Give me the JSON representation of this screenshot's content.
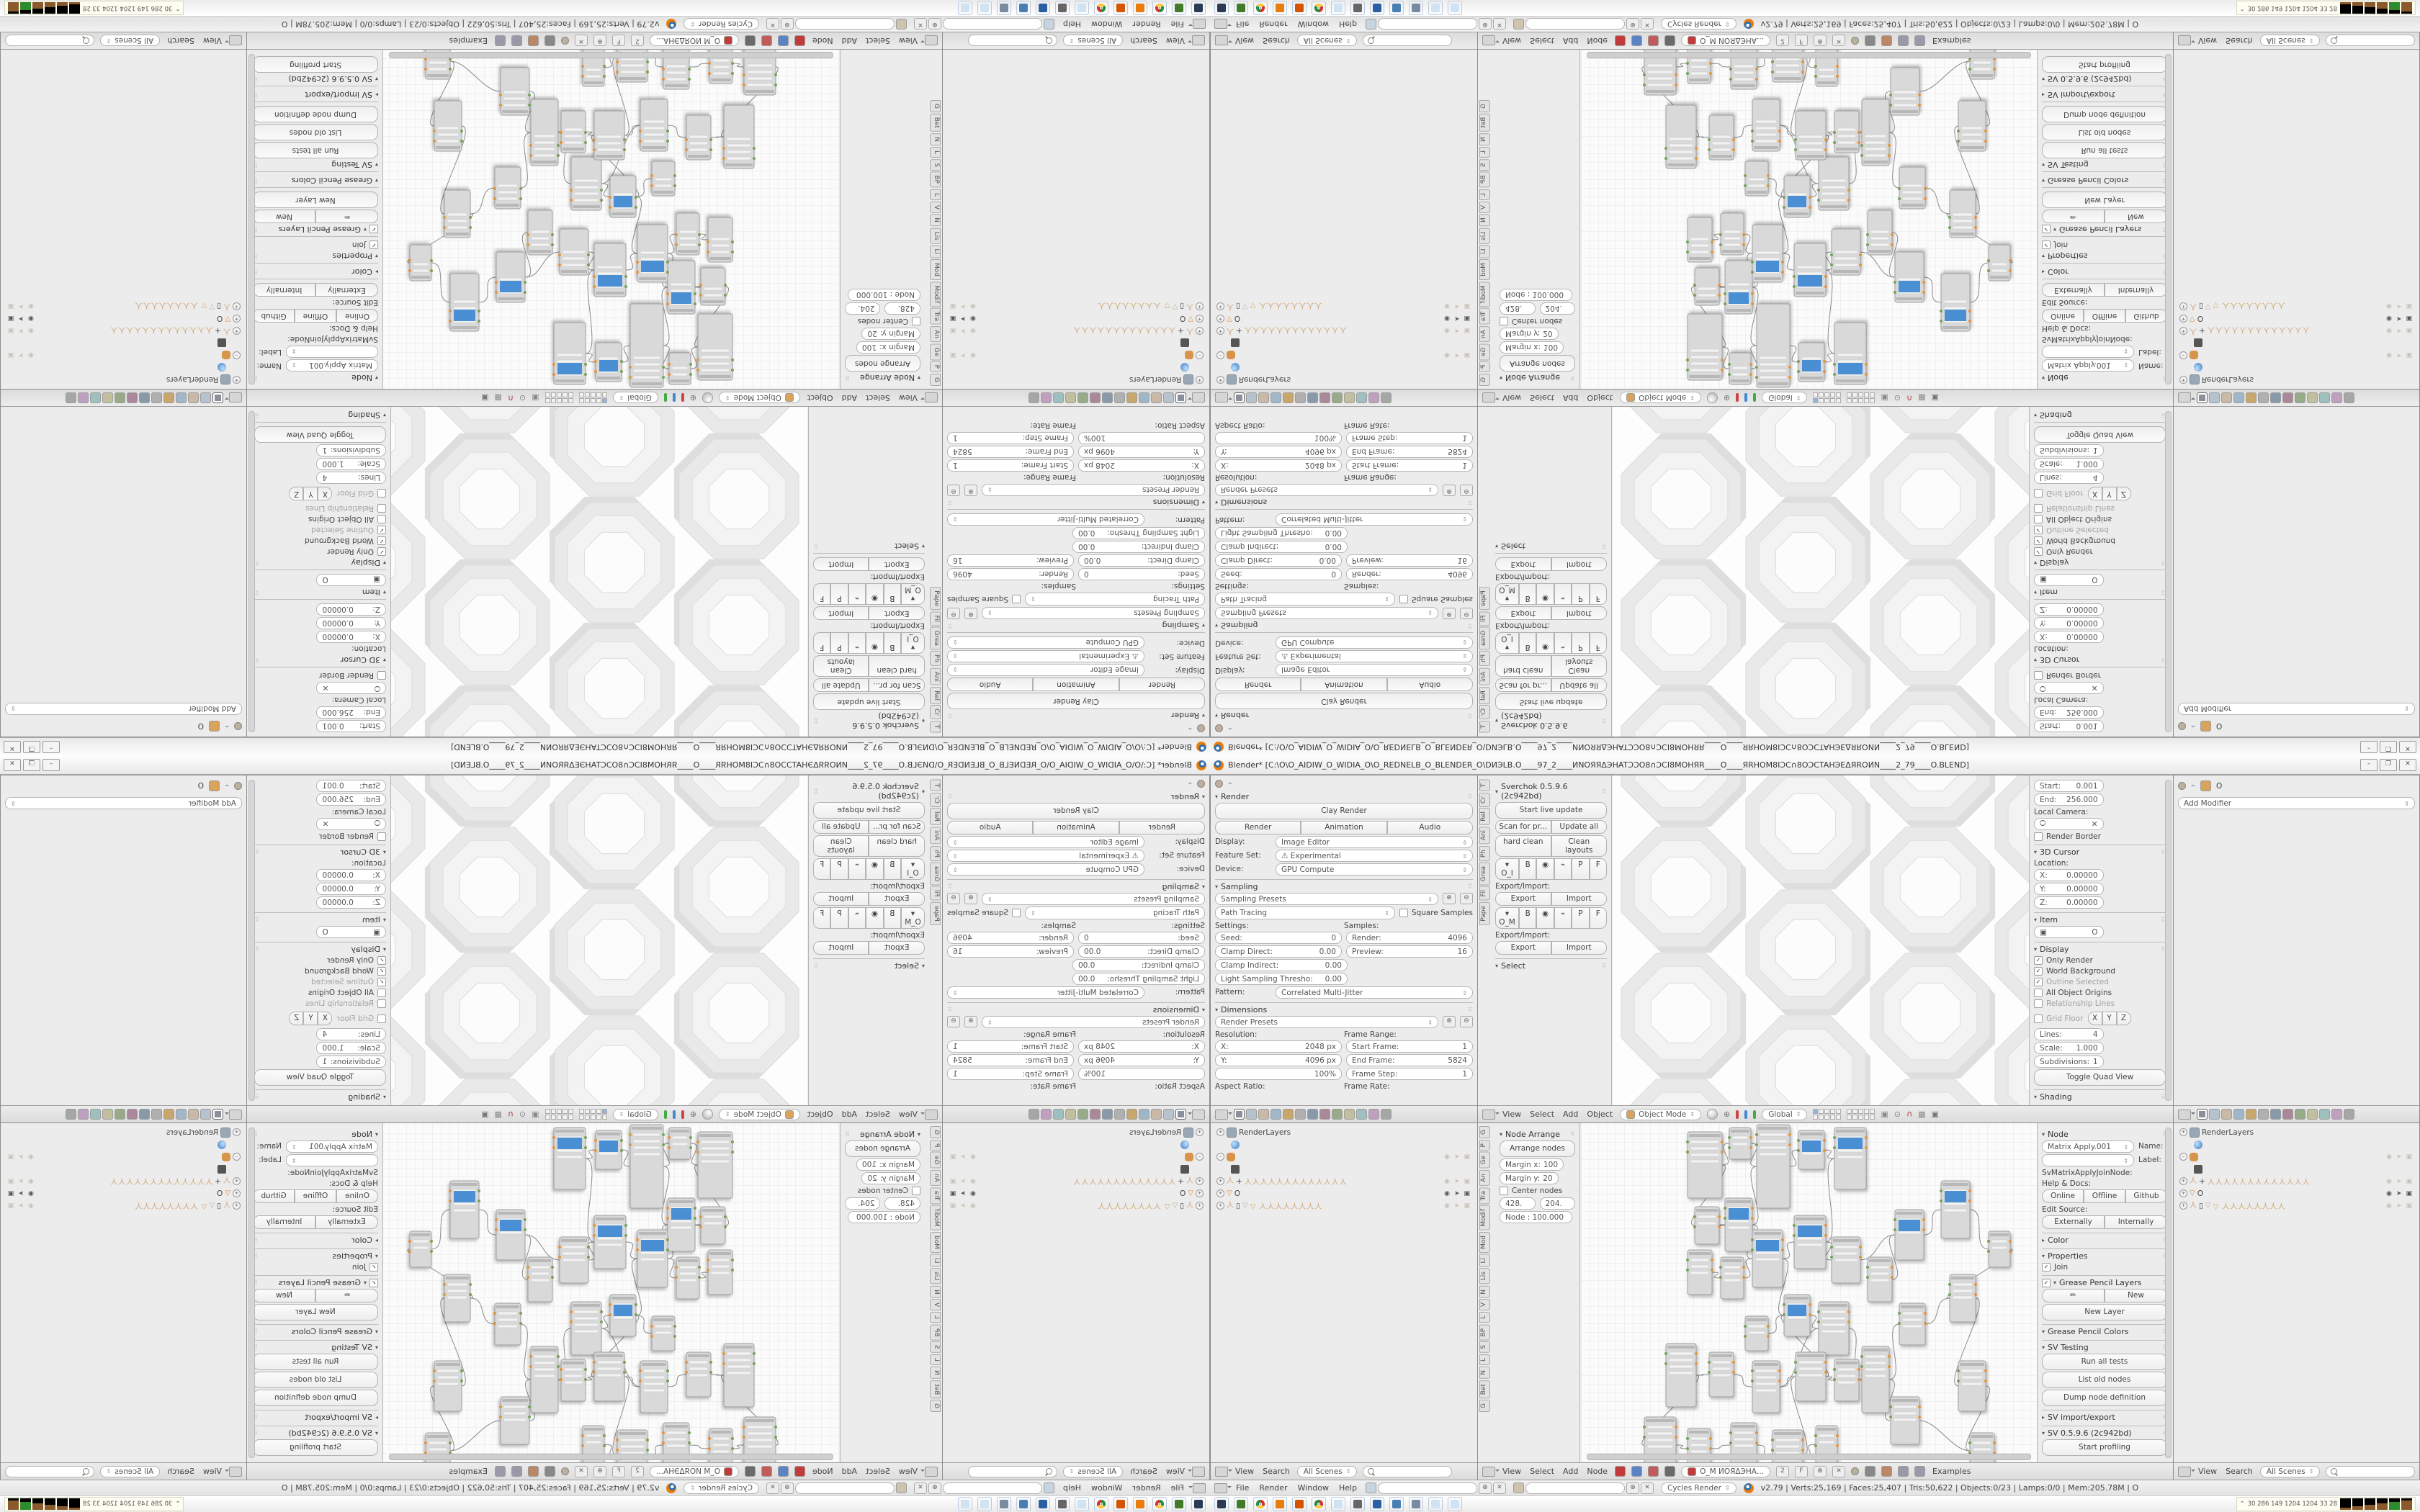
{
  "window": {
    "title": "Blender* [C:\\O\\O_AIDIW_O_WIDIA_O\\O_REDNELB_O_BLENDER_O\\DИЭLB.O____97_2____ИNOЯЯΔЭHATƆƆO8∩ƆCI8MOHЯR____O____ЯRHOM8IƆC∩8OƆCTAHЭEΔЯROИN____2_79____O.BLEND]",
    "controls": {
      "minimize": "–",
      "maximize": "❐",
      "close": "✕"
    }
  },
  "colors": {
    "accent_blue": "#4a8fd3",
    "blender_orange": "#e87d0d",
    "node_fill": "#d9d9d9",
    "wire": "#8a8a8a",
    "socket_green": "#7aa05a",
    "socket_orange": "#e0953f",
    "prop_tabs": [
      "#8a8f99",
      "#b7c3cc",
      "#c9b9a6",
      "#9fb7c9",
      "#c9a66b",
      "#b0b0b0",
      "#8899aa",
      "#aa8899",
      "#99aa88",
      "#c0c0a0",
      "#a0c0c0",
      "#c0a0c0",
      "#a6a6a6"
    ],
    "node_header_chips": [
      "#c23b3b",
      "#5a84c4",
      "#c25b5b",
      "#6a6a6a"
    ],
    "taskbar_icons": [
      {
        "name": "system-monitor-icon",
        "c": "#2b3a55"
      },
      {
        "name": "package-manager-icon",
        "c": "#3f7d2c"
      },
      {
        "name": "chrome-icon",
        "c": "#d93025"
      },
      {
        "name": "blender-app-icon",
        "c": "#e87d0d"
      },
      {
        "name": "spiral-app-icon",
        "c": "#d45500"
      },
      {
        "name": "browser-icon",
        "c": "#1a73e8"
      },
      {
        "name": "notepad-icon",
        "c": "#cfe3f5"
      },
      {
        "name": "speaker-icon",
        "c": "#666666"
      },
      {
        "name": "fl64-icon",
        "c": "#2b5fa3"
      },
      {
        "name": "image-viewer-icon",
        "c": "#4a7fb5"
      },
      {
        "name": "calculator-icon",
        "c": "#7a8aa0"
      },
      {
        "name": "notepad2-icon",
        "c": "#cfe3f5"
      },
      {
        "name": "notepad3-icon",
        "c": "#cfe3f5"
      }
    ]
  },
  "props_render": {
    "panels": [
      {
        "t": "pins"
      },
      {
        "t": "ph",
        "l": "Render"
      },
      {
        "t": "btnbig",
        "l": "Clay Render"
      },
      {
        "t": "btnrow",
        "b": [
          "Render",
          "Animation",
          "Audio"
        ]
      },
      {
        "t": "selrow",
        "l": "Display:",
        "v": "Image Editor"
      },
      {
        "t": "selrow",
        "l": "Feature Set:",
        "v": "⚠ Experimental"
      },
      {
        "t": "selrow",
        "l": "Device:",
        "v": "GPU Compute"
      },
      {
        "t": "ph",
        "l": "Sampling",
        "rule": 1
      },
      {
        "t": "preset",
        "l": "Sampling Presets"
      },
      {
        "t": "pathrow",
        "l": "Path Tracing",
        "c": "Square Samples"
      },
      {
        "t": "lblrow",
        "a": "Settings:",
        "b": "Samples:"
      },
      {
        "t": "fld2",
        "a": {
          "l": "Seed:",
          "v": "0"
        },
        "b": {
          "l": "Render:",
          "v": "4096"
        }
      },
      {
        "t": "fld2",
        "a": {
          "l": "Clamp Direct:",
          "v": "0.00"
        },
        "b": {
          "l": "Preview:",
          "v": "16"
        }
      },
      {
        "t": "fld2",
        "a": {
          "l": "Clamp Indirect:",
          "v": "0.00"
        }
      },
      {
        "t": "fld2",
        "a": {
          "l": "Light Sampling Thresho:",
          "v": "0.00"
        }
      },
      {
        "t": "selrow",
        "l": "Pattern:",
        "v": "Correlated Multi-Jitter"
      },
      {
        "t": "ph",
        "l": "Dimensions",
        "rule": 1
      },
      {
        "t": "preset",
        "l": "Render Presets"
      },
      {
        "t": "lblrow",
        "a": "Resolution:",
        "b": "Frame Range:"
      },
      {
        "t": "fld2",
        "a": {
          "l": "X:",
          "v": "2048 px"
        },
        "b": {
          "l": "Start Frame:",
          "v": "1"
        }
      },
      {
        "t": "fld2",
        "a": {
          "l": "Y:",
          "v": "4096 px"
        },
        "b": {
          "l": "End Frame:",
          "v": "5824"
        }
      },
      {
        "t": "fld2",
        "a": {
          "l": "",
          "v": "100%"
        },
        "b": {
          "l": "Frame Step:",
          "v": "1"
        }
      },
      {
        "t": "lblrow",
        "a": "Aspect Ratio:",
        "b": "Frame Rate:"
      }
    ]
  },
  "view3d": {
    "toolshelf": {
      "tabs": [
        "T",
        "Cr",
        "Rel",
        "Ani",
        "Ph",
        "Grea",
        "Fil",
        "Pape"
      ],
      "panels": [
        {
          "t": "ph",
          "l": "Sverchok 0.5.9.6 (2c942bd)"
        },
        {
          "t": "btnbig",
          "l": "Start live update"
        },
        {
          "t": "btnrow",
          "b": [
            "Scan for pr...",
            "Update all"
          ]
        },
        {
          "t": "btnrow",
          "b": [
            "hard clean",
            "Clean layouts"
          ]
        },
        {
          "t": "grouprow",
          "l": "O_I",
          "b": [
            "B",
            "◉",
            "⌁",
            "P",
            "F"
          ]
        },
        {
          "t": "lbl",
          "l": "Export/Import:"
        },
        {
          "t": "btnrow",
          "b": [
            "Export",
            "Import"
          ]
        },
        {
          "t": "grouprow",
          "l": "O_M",
          "b": [
            "B",
            "◉",
            "⌁",
            "P",
            "F"
          ]
        },
        {
          "t": "lbl",
          "l": "Export/Import:"
        },
        {
          "t": "btnrow",
          "b": [
            "Export",
            "Import"
          ]
        },
        {
          "t": "ph",
          "l": "Select",
          "rule": 1
        }
      ]
    },
    "npanel": {
      "panels": [
        {
          "t": "fld2",
          "a": {
            "l": "Start:",
            "v": "0.001"
          }
        },
        {
          "t": "fld2",
          "a": {
            "l": "End:",
            "v": "256.000"
          }
        },
        {
          "t": "lbl",
          "l": "Local Camera:"
        },
        {
          "t": "fld2",
          "a": {
            "l": "🞅",
            "v": "✕"
          }
        },
        {
          "t": "chk",
          "l": "Render Border",
          "on": 0
        },
        {
          "t": "ph",
          "l": "3D Cursor",
          "rule": 1
        },
        {
          "t": "lbl",
          "l": "Location:"
        },
        {
          "t": "fld2",
          "a": {
            "l": "X:",
            "v": "0.00000"
          }
        },
        {
          "t": "fld2",
          "a": {
            "l": "Y:",
            "v": "0.00000"
          }
        },
        {
          "t": "fld2",
          "a": {
            "l": "Z:",
            "v": "0.00000"
          }
        },
        {
          "t": "ph",
          "l": "Item",
          "rule": 1
        },
        {
          "t": "fld2",
          "a": {
            "l": "▣",
            "v": "O"
          }
        },
        {
          "t": "ph",
          "l": "Display",
          "rule": 1
        },
        {
          "t": "chk",
          "l": "Only Render",
          "on": 1
        },
        {
          "t": "chk",
          "l": "World Background",
          "on": 1
        },
        {
          "t": "chk",
          "l": "Outline Selected",
          "on": 1,
          "dim": 1
        },
        {
          "t": "chk",
          "l": "All Object Origins",
          "on": 0
        },
        {
          "t": "chk",
          "l": "Relationship Lines",
          "on": 0,
          "dim": 1
        },
        {
          "t": "gridfloor",
          "l": "Grid Floor",
          "axes": [
            "X",
            "Y",
            "Z"
          ]
        },
        {
          "t": "fld2",
          "a": {
            "l": "Lines:",
            "v": "4"
          }
        },
        {
          "t": "fld2",
          "a": {
            "l": "Scale:",
            "v": "1.000"
          }
        },
        {
          "t": "fld2",
          "a": {
            "l": "Subdivisions:",
            "v": "1"
          }
        },
        {
          "t": "btnbig",
          "l": "Toggle Quad View"
        },
        {
          "t": "ph",
          "l": "Shading",
          "rule": 1
        }
      ]
    },
    "header": {
      "menus": [
        "View",
        "Select",
        "Add",
        "Object"
      ],
      "mode": "Object Mode",
      "space": "Global"
    }
  },
  "props_modifier": {
    "object_name": "O",
    "add_modifier": "Add Modifier"
  },
  "outliner": {
    "rows": [
      {
        "exp": "+",
        "icon": "rl",
        "label": "RenderLayers",
        "extra": 1
      },
      {
        "icon": "world",
        "ind": 1
      },
      {
        "exp": "–",
        "icon": "grp",
        "tog": "dim"
      },
      {
        "icon": "cam",
        "ind": 1
      },
      {
        "exp": "+",
        "icon": "arm",
        "label": "+",
        "chain": 13,
        "tog": "dim"
      },
      {
        "exp": "+",
        "icon": "tri",
        "label": "O",
        "tri": 1,
        "tog": "on"
      },
      {
        "exp": "+",
        "icon": "arm",
        "label": "▯",
        "chain": 8,
        "tri": 1,
        "tog": "dim"
      }
    ],
    "header": {
      "menus": [
        "View",
        "Search"
      ],
      "scenes": "All Scenes"
    }
  },
  "node_editor": {
    "toolshelf": {
      "tabs": [
        "G",
        "P",
        "Ge",
        "An",
        "Tra",
        "Modif",
        "Mod",
        "Li",
        "Lis",
        "N",
        "V",
        "L",
        "BP",
        "S",
        "L",
        "N",
        "Bet",
        "G"
      ],
      "panels": [
        {
          "t": "ph",
          "l": "Node Arrange"
        },
        {
          "t": "btnbig",
          "l": "Arrange nodes"
        },
        {
          "t": "fld2",
          "a": {
            "l": "Margin x:",
            "v": "100"
          }
        },
        {
          "t": "fld2",
          "a": {
            "l": "Margin y:",
            "v": "20"
          }
        },
        {
          "t": "chk",
          "l": "Center nodes",
          "on": 0
        },
        {
          "t": "fld2",
          "a": {
            "l": "428.",
            "v": ""
          },
          "b": {
            "l": "204.",
            "v": ""
          }
        },
        {
          "t": "fld2",
          "a": {
            "l": "Node : 100.000",
            "v": ""
          }
        }
      ]
    },
    "npanel": {
      "panels": [
        {
          "t": "ph",
          "l": "Node"
        },
        {
          "t": "selrow",
          "l": "Name:",
          "v": "Matrix Apply.001"
        },
        {
          "t": "selrow",
          "l": "Label:",
          "v": ""
        },
        {
          "t": "lbl",
          "l": "SvMatrixApplyJoinNode:"
        },
        {
          "t": "lbl",
          "l": "Help & Docs:"
        },
        {
          "t": "btnrow",
          "b": [
            "Online",
            "Offline",
            "Github"
          ]
        },
        {
          "t": "lbl",
          "l": "Edit Source:"
        },
        {
          "t": "btnrow",
          "b": [
            "Externally",
            "Internally"
          ]
        },
        {
          "t": "ph",
          "l": "Color",
          "tri": "▸",
          "rule": 1
        },
        {
          "t": "ph",
          "l": "Properties",
          "rule": 1
        },
        {
          "t": "chk",
          "l": "Join",
          "on": 1
        },
        {
          "t": "ph",
          "l": "Grease Pencil Layers",
          "rule": 1,
          "check": 1
        },
        {
          "t": "btnrow",
          "b": [
            "✏",
            "New"
          ]
        },
        {
          "t": "btnbig",
          "l": "New Layer"
        },
        {
          "t": "ph",
          "l": "Grease Pencil Colors",
          "rule": 1
        },
        {
          "t": "ph",
          "l": "SV Testing",
          "rule": 1
        },
        {
          "t": "btnbig",
          "l": "Run all tests"
        },
        {
          "t": "btnbig",
          "l": "List old nodes"
        },
        {
          "t": "btnbig",
          "l": "Dump node definition"
        },
        {
          "t": "ph",
          "l": "SV import/export",
          "tri": "▸",
          "rule": 1
        },
        {
          "t": "ph",
          "l": "SV 0.5.9.6 (2c942bd)",
          "rule": 1
        },
        {
          "t": "btnbig",
          "l": "Start profiling"
        }
      ]
    },
    "header": {
      "menus": [
        "View",
        "Select",
        "Add",
        "Node"
      ],
      "tree_name": "O_M ИОЯΔЭНА...",
      "users": "2",
      "fake": "F",
      "examples": "Examples"
    }
  },
  "info_bar": {
    "menus": [
      "File",
      "Render",
      "Window",
      "Help"
    ],
    "engine": "Cycles Render",
    "stats": "v2.79 | Verts:25,169 | Faces:25,407 | Tris:50,622 | Objects:0/23 | Lamps:0/0 | Mem:205.78M | O"
  },
  "taskbar": {
    "tray_numbers": "30  286  149  1204 1204  33  28"
  },
  "node_graph": {
    "nodes": [
      [
        148,
        12,
        48,
        92,
        0
      ],
      [
        206,
        6,
        30,
        44,
        0
      ],
      [
        244,
        2,
        46,
        116,
        0
      ],
      [
        302,
        10,
        36,
        54,
        1
      ],
      [
        352,
        6,
        44,
        86,
        1
      ],
      [
        158,
        116,
        34,
        52,
        0
      ],
      [
        200,
        104,
        38,
        74,
        1
      ],
      [
        148,
        176,
        34,
        62,
        0
      ],
      [
        194,
        186,
        32,
        58,
        0
      ],
      [
        238,
        148,
        42,
        80,
        1
      ],
      [
        296,
        128,
        44,
        74,
        1
      ],
      [
        348,
        158,
        40,
        64,
        0
      ],
      [
        282,
        238,
        36,
        58,
        1
      ],
      [
        330,
        248,
        42,
        74,
        0
      ],
      [
        228,
        268,
        32,
        48,
        0
      ],
      [
        118,
        306,
        42,
        88,
        0
      ],
      [
        178,
        318,
        34,
        62,
        0
      ],
      [
        238,
        330,
        38,
        72,
        0
      ],
      [
        298,
        318,
        42,
        68,
        0
      ],
      [
        352,
        328,
        34,
        58,
        0
      ],
      [
        88,
        408,
        44,
        78,
        0
      ],
      [
        148,
        424,
        32,
        56,
        0
      ],
      [
        208,
        416,
        36,
        62,
        0
      ],
      [
        266,
        426,
        42,
        72,
        0
      ],
      [
        326,
        420,
        30,
        52,
        0
      ],
      [
        390,
        310,
        38,
        92,
        0
      ],
      [
        398,
        186,
        34,
        62,
        0
      ],
      [
        436,
        120,
        40,
        70,
        1
      ],
      [
        442,
        250,
        36,
        58,
        0
      ],
      [
        430,
        380,
        40,
        66,
        0
      ],
      [
        500,
        80,
        40,
        80,
        1
      ],
      [
        512,
        210,
        36,
        66,
        0
      ],
      [
        524,
        330,
        38,
        70,
        0
      ],
      [
        540,
        430,
        34,
        50,
        0
      ],
      [
        566,
        150,
        30,
        50,
        0
      ]
    ],
    "links": [
      [
        0,
        1
      ],
      [
        1,
        2
      ],
      [
        2,
        3
      ],
      [
        3,
        4
      ],
      [
        0,
        5
      ],
      [
        5,
        6
      ],
      [
        6,
        9
      ],
      [
        7,
        8
      ],
      [
        8,
        9
      ],
      [
        9,
        10
      ],
      [
        10,
        4
      ],
      [
        10,
        11
      ],
      [
        11,
        27
      ],
      [
        9,
        12
      ],
      [
        12,
        13
      ],
      [
        13,
        25
      ],
      [
        14,
        12
      ],
      [
        15,
        16
      ],
      [
        16,
        17
      ],
      [
        17,
        18
      ],
      [
        18,
        19
      ],
      [
        19,
        25
      ],
      [
        15,
        20
      ],
      [
        20,
        21
      ],
      [
        21,
        22
      ],
      [
        22,
        23
      ],
      [
        23,
        24
      ],
      [
        25,
        28
      ],
      [
        26,
        27
      ],
      [
        27,
        30
      ],
      [
        28,
        31
      ],
      [
        18,
        12
      ],
      [
        6,
        2
      ],
      [
        17,
        13
      ],
      [
        23,
        18
      ],
      [
        30,
        34
      ],
      [
        31,
        32
      ],
      [
        32,
        33
      ],
      [
        29,
        33
      ],
      [
        25,
        29
      ],
      [
        34,
        31
      ]
    ]
  },
  "honeycomb": {
    "r": 90,
    "cells": [
      [
        95,
        -20
      ],
      [
        95,
        155
      ],
      [
        95,
        330
      ],
      [
        95,
        505
      ],
      [
        268,
        67
      ],
      [
        268,
        242
      ],
      [
        268,
        417
      ],
      [
        441,
        -20
      ],
      [
        441,
        155
      ],
      [
        441,
        330
      ],
      [
        441,
        505
      ],
      [
        614,
        67
      ],
      [
        614,
        242
      ],
      [
        614,
        417
      ]
    ]
  }
}
